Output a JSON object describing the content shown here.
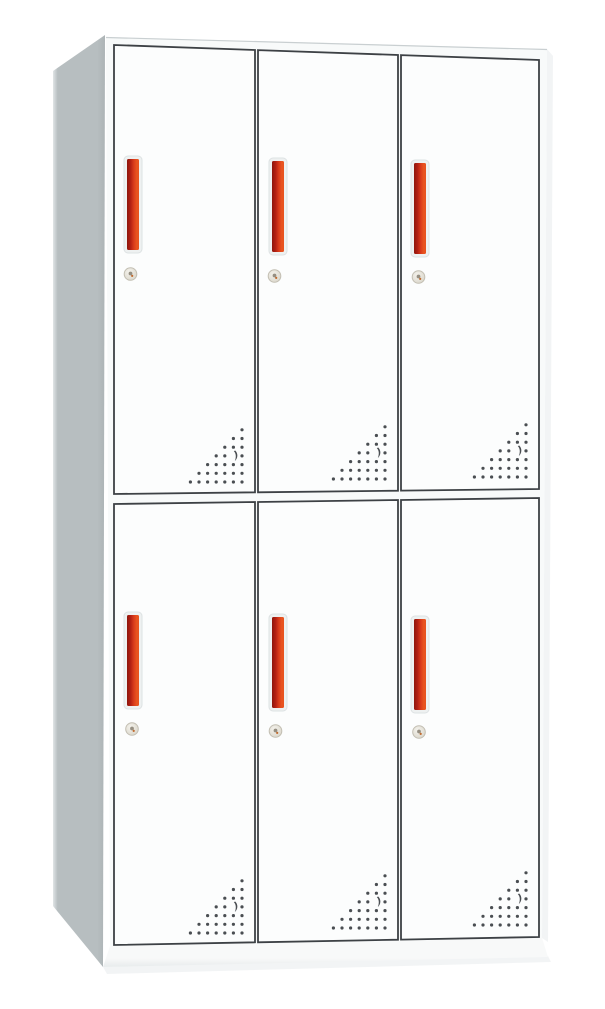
{
  "product": {
    "name": "six-door-locker-cabinet",
    "rows": 2,
    "columns": 3,
    "door_count": 6,
    "features": [
      "vertical-red-handle",
      "round-cam-lock",
      "triangular-vent-perforations"
    ]
  },
  "colors": {
    "background": "#ffffff",
    "cabinet_face": "#f8fafa",
    "face_top_edge": "#c9cfd1",
    "door_face": "#fcfdfd",
    "door_border": "#3d4145",
    "side_panel": "#b7bec0",
    "side_panel_highlight": "#e0e5e6",
    "side_panel_deep": "#adb4b6",
    "plinth_top": "#f8f9f9",
    "plinth_bottom": "#e7ebec",
    "plinth_edge": "#d3d8d9",
    "shadow_soft": "#edf0f1",
    "handle_dark": "#8e160c",
    "handle_mid": "#b32013",
    "handle_hot": "#d8391a",
    "handle_bright": "#e8531f",
    "handle_recess": "#eef1f1",
    "handle_recess_edge": "#dde2e3",
    "lock_body_light": "#f4f2ec",
    "lock_body_dark": "#d9d5c9",
    "lock_ring": "#c2beb2",
    "lock_keyhole": "#968f82",
    "lock_accent": "#c06b30",
    "vent_dot": "#4a4e52"
  },
  "doors": [
    {
      "id": "door-top-left",
      "row": 1,
      "col": 1
    },
    {
      "id": "door-top-middle",
      "row": 1,
      "col": 2
    },
    {
      "id": "door-top-right",
      "row": 1,
      "col": 3
    },
    {
      "id": "door-bottom-left",
      "row": 2,
      "col": 1
    },
    {
      "id": "door-bottom-middle",
      "row": 2,
      "col": 2
    },
    {
      "id": "door-bottom-right",
      "row": 2,
      "col": 3
    }
  ],
  "vents": {
    "rows": 7,
    "spacing_x": 8.6,
    "spacing_y": 8.7,
    "dot_radius": 1.6,
    "crescent_row": 3,
    "crescent_index": 1
  }
}
